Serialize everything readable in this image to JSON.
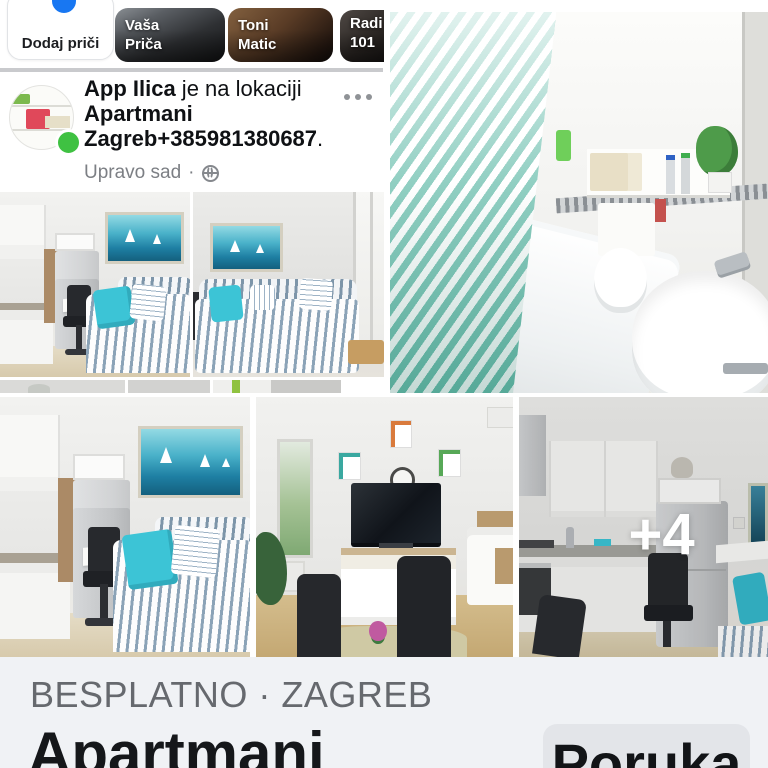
{
  "stories": {
    "items": [
      {
        "label_lines": [
          "Dodaj priči"
        ]
      },
      {
        "label_lines": [
          "Vaša",
          "Priča"
        ]
      },
      {
        "label_lines": [
          "Toni",
          "Matic"
        ]
      },
      {
        "label_lines": [
          "Radi",
          "101"
        ]
      }
    ]
  },
  "post": {
    "author": "App Ilica",
    "connector": " je na lokaciji ",
    "location": "Apartmani Zagreb+385981380687",
    "suffix": ".",
    "timestamp": "Upravo sad",
    "meta_separator": "·"
  },
  "collage": {
    "more_overlay": "+4",
    "photos": [
      {
        "name": "living-room-with-kitchen"
      },
      {
        "name": "living-room-with-sofa-and-window"
      },
      {
        "name": "bathroom-with-tub-and-sink"
      },
      {
        "name": "living-room-with-kitchen-2"
      },
      {
        "name": "tv-room-with-dining-table"
      },
      {
        "name": "kitchen-with-fridge"
      }
    ]
  },
  "footer": {
    "category": "BESPLATNO · ZAGREB",
    "title": "Apartmani",
    "message_button": "Poruka"
  },
  "icons": {
    "more_options": "ellipsis",
    "globe": "public-audience",
    "add_story": "plus-circle",
    "online_status": "green-dot"
  },
  "colors": {
    "accent_blue": "#1877f2",
    "online_green": "#3fc142",
    "footer_bg": "#f0f2f5",
    "button_bg": "#e3e5e9",
    "muted_text": "#66696e",
    "teal_accent": "#3cc4d6"
  }
}
